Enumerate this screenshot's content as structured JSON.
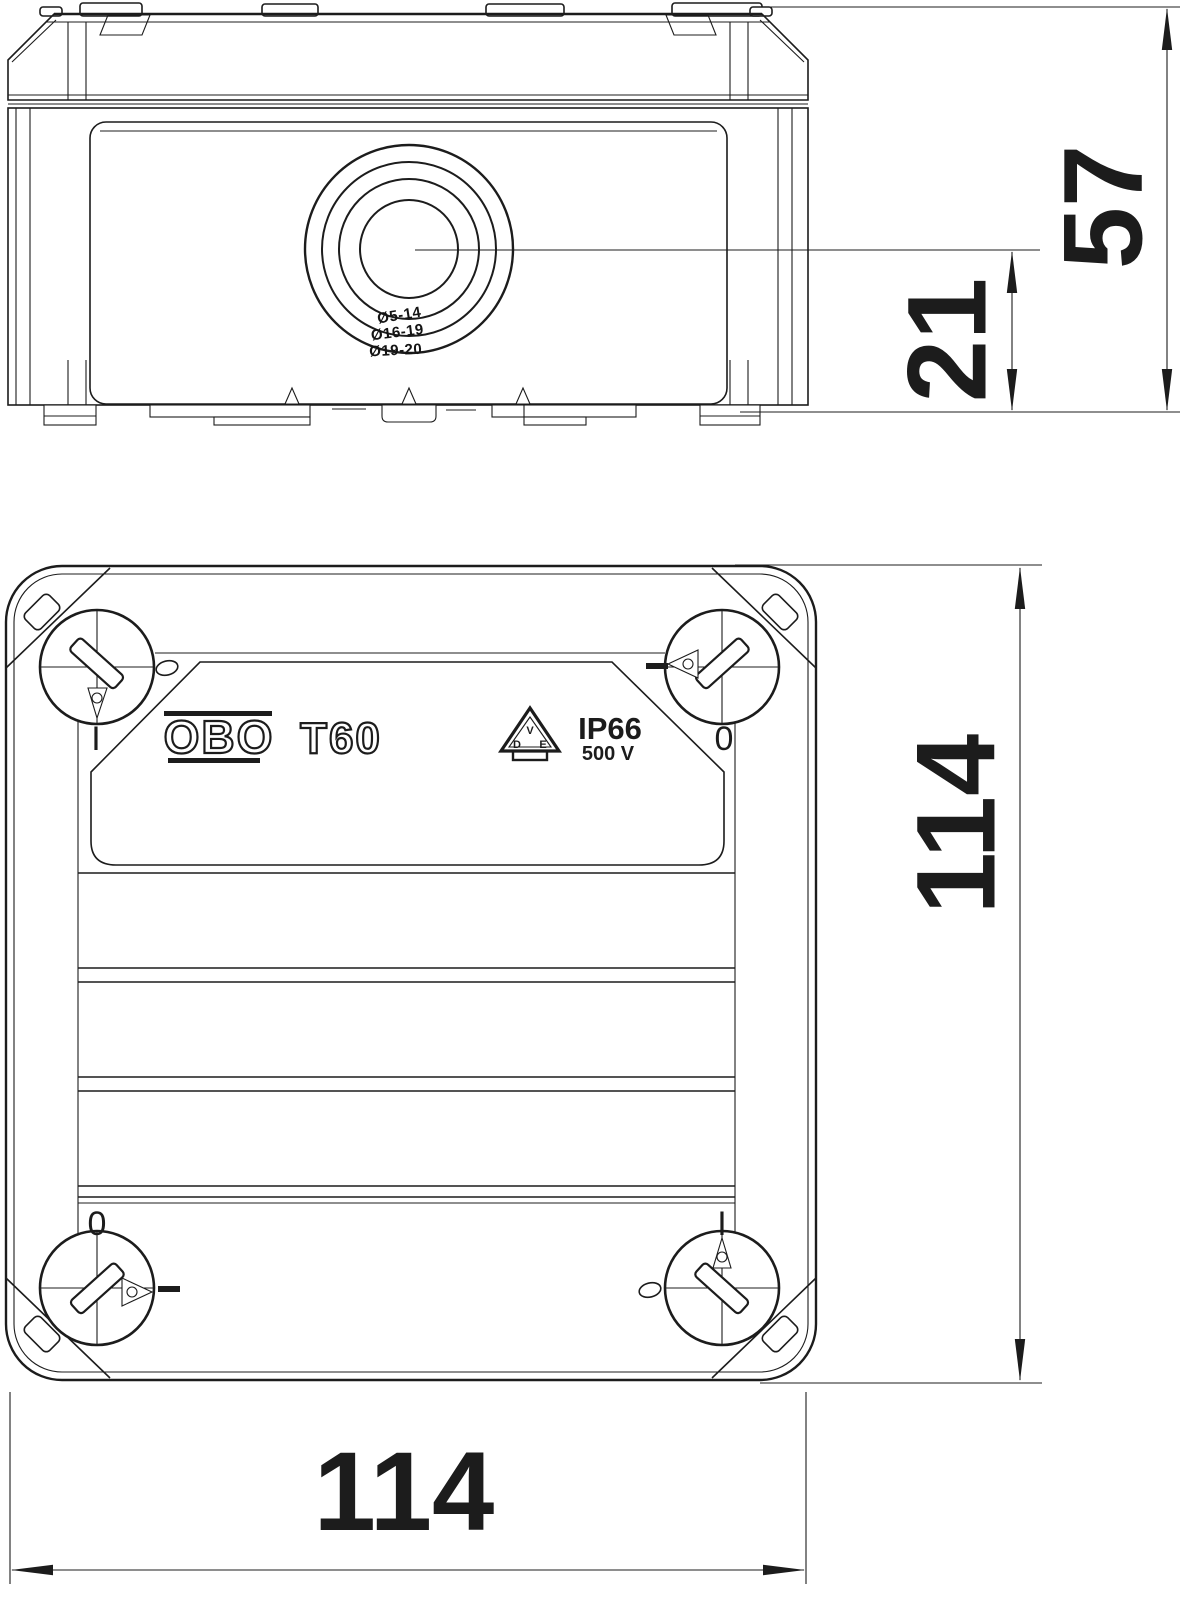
{
  "colors": {
    "ink": "#1c1c1c",
    "paper": "#ffffff"
  },
  "product": {
    "brand": "OBO",
    "model": "T60",
    "protection_rating": "IP66",
    "voltage": "500 V",
    "vde_mark": {
      "v": "V",
      "d": "D",
      "e": "E"
    }
  },
  "grommet_labels": {
    "inner": "Ø5-14",
    "middle": "Ø16-19",
    "outer": "Ø19-20"
  },
  "corner_marks": {
    "top_left": "I",
    "top_right": "0",
    "bottom_left": "0",
    "bottom_right": "I"
  },
  "dimensions": {
    "total_height": "57",
    "entry_center_height": "21",
    "body_width": "114",
    "body_depth": "114"
  }
}
